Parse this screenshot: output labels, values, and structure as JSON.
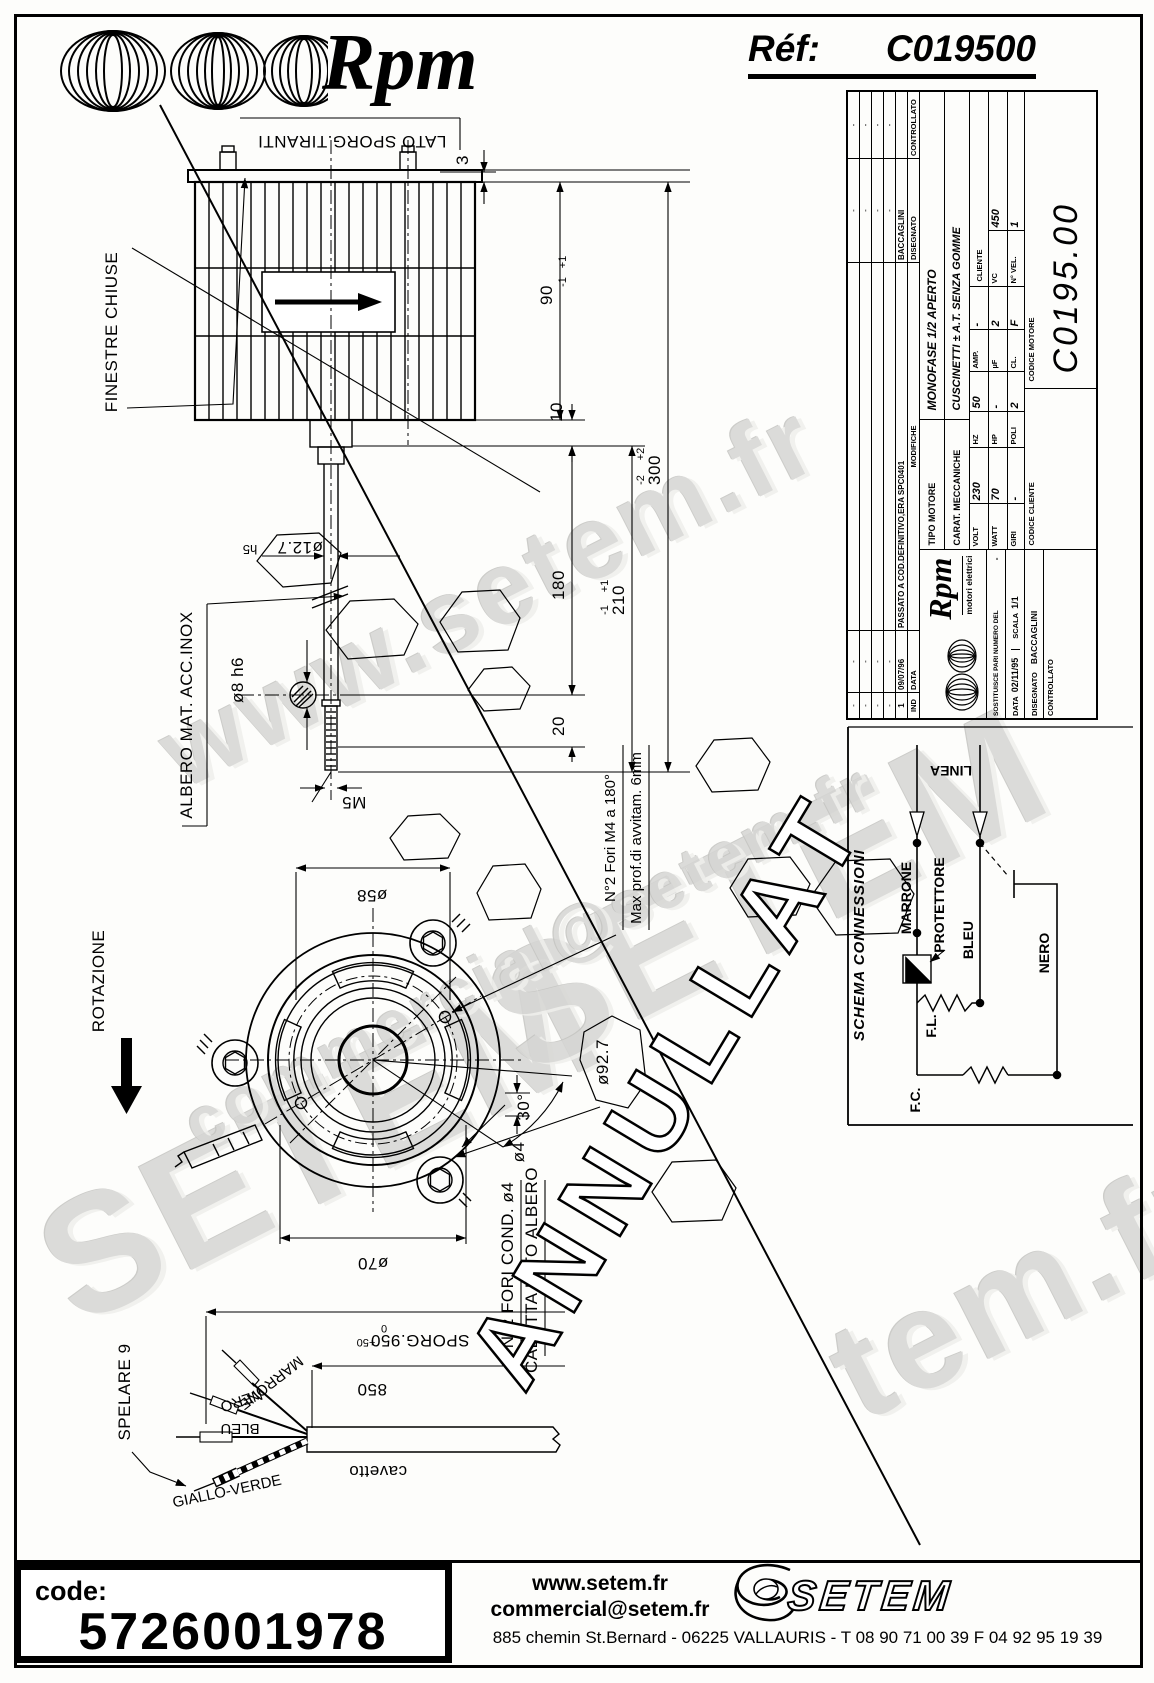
{
  "header": {
    "brand_script": "Rpm",
    "ref_label": "Réf:",
    "ref_value": "C019500"
  },
  "title_block": {
    "revisions": {
      "col_ind": "IND",
      "col_data": "DATA",
      "col_modifiche": "MODIFICHE",
      "col_disegnato": "DISEGNATO",
      "col_controllato": "CONTROLLATO",
      "dash": "-",
      "rev_ind": "1",
      "rev_data": "09/07/96",
      "rev_modifiche": "PASSATO A COD.DEFINITIVO,ERA SPC0401",
      "rev_disegnato": "BACCAGLINI"
    },
    "logo": {
      "script": "Rpm",
      "subtitle": "motori elettrici"
    },
    "sostituisce_label": "SOSTITUISCE PARI NUMERO DEL",
    "sostituisce_value": "-",
    "data_label": "DATA",
    "data_value": "02/11/95",
    "scala_label": "SCALA",
    "scala_value": "1/1",
    "disegnato_label": "DISEGNATO",
    "disegnato_value": "BACCAGLINI",
    "controllato_label": "CONTROLLATO",
    "tipo_label": "TIPO MOTORE",
    "tipo_value": "MONOFASE 1/2 APERTO",
    "carat_label": "CARAT. MECCANICHE",
    "carat_value": "CUSCINETTI ± A.T. SENZA GOMME",
    "specs": {
      "volt_label": "VOLT",
      "volt": "230",
      "hz_label": "HZ",
      "hz": "50",
      "amp_label": "AMP.",
      "amp": "-",
      "watt_label": "WATT",
      "watt": "70",
      "hp_label": "HP",
      "hp": "-",
      "uf_label": "µF",
      "uf": "2",
      "vc_label": "VC",
      "vc": "450",
      "giri_label": "GIRI",
      "giri": "-",
      "poli_label": "POLI",
      "poli": "2",
      "cl_label": "CL.",
      "cl": "F",
      "nvel_label": "N° VEL.",
      "nvel": "1"
    },
    "cliente_label": "CLIENTE",
    "codice_cliente_label": "CODICE CLIENTE",
    "codice_motore_label": "CODICE MOTORE",
    "codice_motore": "C0195.00"
  },
  "schema": {
    "title": "SCHEMA CONNESSIONI",
    "linea": "LINEA",
    "marrone": "MARRONE",
    "protettore": "PROTETTORE",
    "bleu": "BLEU",
    "nero": "NERO",
    "fl": "F.L.",
    "fc": "F.C."
  },
  "drawing": {
    "lato_sporg": "LATO SPORG.TIRANTI",
    "finestre": "FINESTRE CHIUSE",
    "rotazione": "ROTAZIONE",
    "albero": "ALBERO MAT. ACC.INOX",
    "spelare": "SPELARE 9",
    "cavetto": "cavetto",
    "fori_m4": "N°2 Fori M4 a 180°",
    "max_prof": "Max prof.di avvitam. 6mm",
    "fori_cond": "N°2 FORI COND. ø4",
    "calotta": "CALOTTA LATO ALBERO",
    "dims": {
      "d3": "3",
      "d90": "90",
      "d90_tp": "+1",
      "d90_tm": "-1",
      "d10": "10",
      "d300": "300",
      "d300_tp": "+2",
      "d300_tm": "-2",
      "d180": "180",
      "d210": "210",
      "d210_tp": "+1",
      "d210_tm": "-1",
      "d20": "20",
      "d127": "ø12.7",
      "h5": "h5",
      "d8": "ø8 h6",
      "m5": "M5",
      "d58": "ø58",
      "d70": "ø70",
      "d927": "ø92.7",
      "a30": "30°",
      "d4": "ø4",
      "d850": "850",
      "sporg": "SPORG.950",
      "sporg_t0": "0",
      "sporg_tp": "+50"
    },
    "wires": {
      "marrone": "MARRONE",
      "nero": "NERO",
      "bleu": "BLEU",
      "giallo_verde": "GIALLO-VERDE"
    },
    "stamp": "ANNULLAT"
  },
  "watermarks": {
    "w1": "www.setem.fr",
    "w2": "SETEM",
    "w3": "SETEM",
    "w4": "commercial@setem.fr",
    "w5": "tem.fr"
  },
  "footer": {
    "code_label": "code:",
    "code_value": "5726001978",
    "site": "www.setem.fr",
    "email": "commercial@setem.fr",
    "brand": "SETEM",
    "address": "885 chemin St.Bernard  -  06225 VALLAURIS  -  T 08 90 71 00 39   F 04 92 95 19 39"
  }
}
